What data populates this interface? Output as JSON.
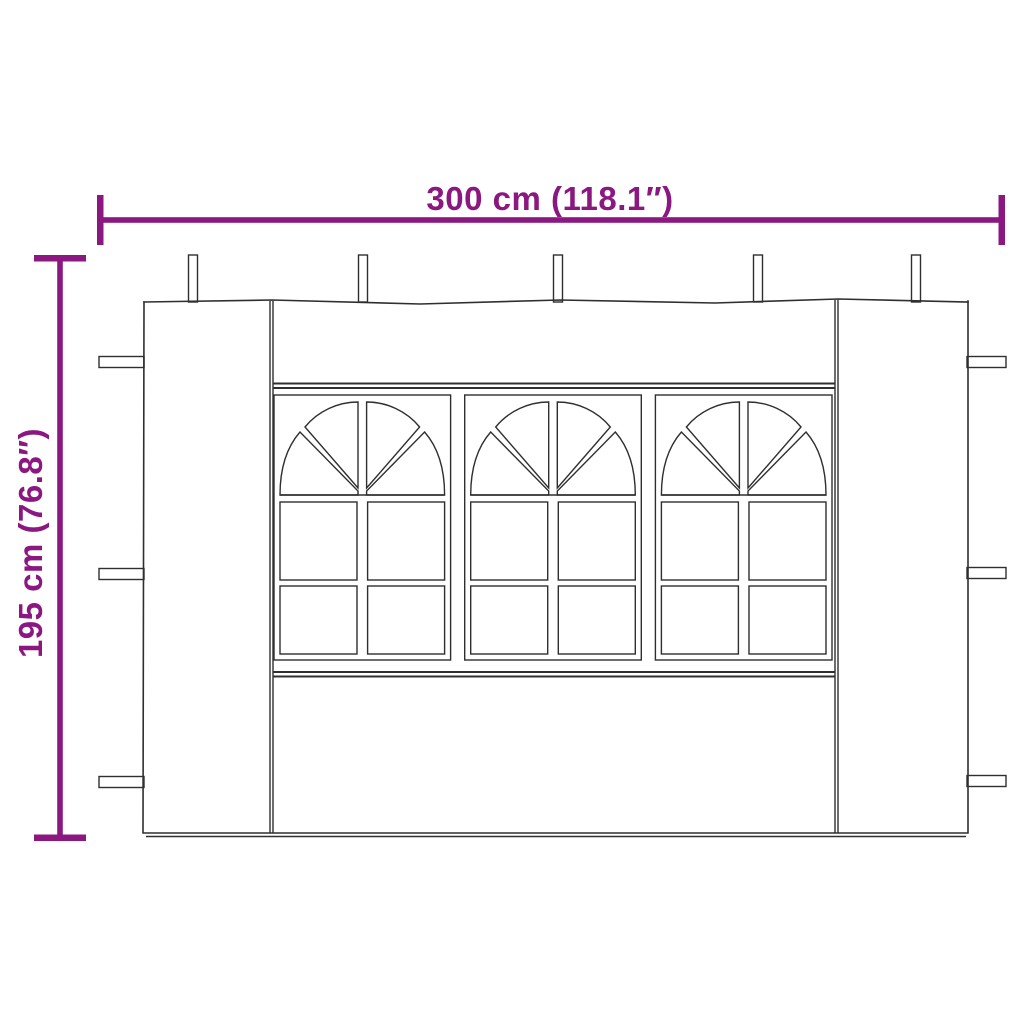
{
  "dimensions": {
    "width_label": "300 cm (118.1″)",
    "height_label": "195 cm (76.8″)"
  },
  "colors": {
    "accent": "#8A1880",
    "line": "#2F2F2F",
    "background": "#FFFFFF"
  },
  "drawing": {
    "subject": "party-tent-sidewall-with-windows",
    "window_count": 3,
    "window_style": "arched fan top with 2x2 pane grid",
    "top_loop_count": 5,
    "left_tab_count": 3,
    "right_tab_count": 3
  }
}
